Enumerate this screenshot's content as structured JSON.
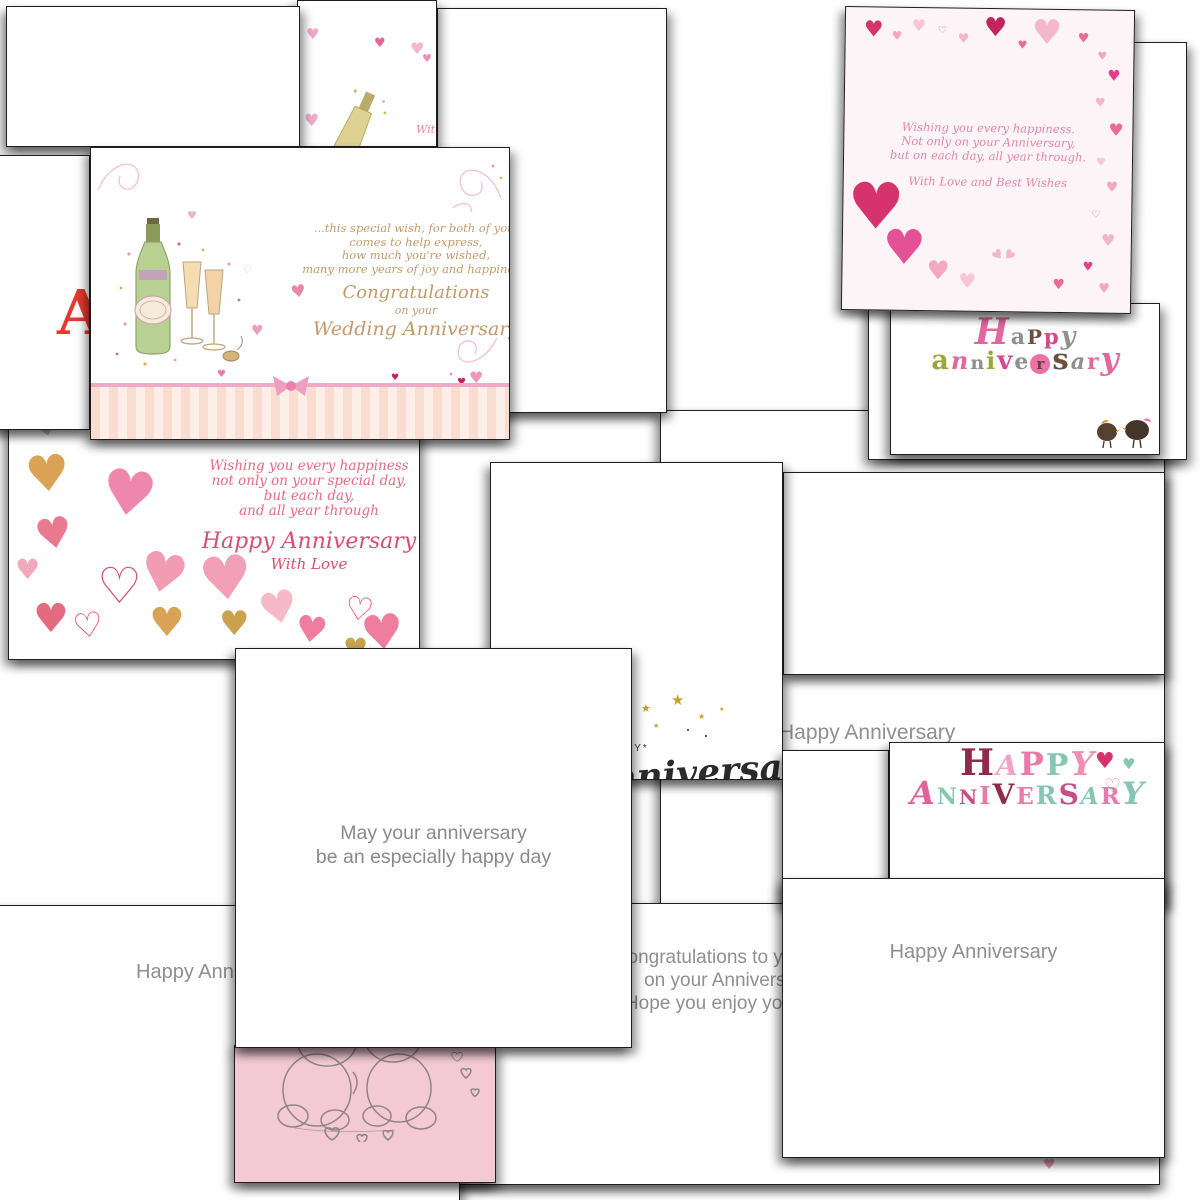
{
  "cards": {
    "front_fragment": {
      "partial_text": "Wit"
    },
    "wedding": {
      "verse": [
        "...this special wish, for both of you,",
        "comes to help express,",
        "how much you're wished,",
        "many more years of joy and happiness."
      ],
      "script1": "Congratulations",
      "script2": "on your",
      "script3": "Wedding Anniversary"
    },
    "letter_fragment": {
      "letter": "A"
    },
    "hearts_border": {
      "verse": [
        "Wishing you every happiness.",
        "Not only on your Anniversary,",
        "but on each day, all year through."
      ],
      "closing": "With Love and Best Wishes"
    },
    "birds": {
      "word1": [
        [
          "H",
          "#e2679f",
          36,
          "i"
        ],
        [
          "a",
          "#8f8f8f",
          22
        ],
        [
          "P",
          "#6b4f3f",
          20
        ],
        [
          "p",
          "#d5488f",
          21
        ],
        [
          "y",
          "#8f8f8f",
          25,
          "i"
        ]
      ],
      "word2": [
        [
          "a",
          "#9aa83b",
          27
        ],
        [
          "n",
          "#e2679f",
          24,
          "i"
        ],
        [
          "n",
          "#8f8f8f",
          19
        ],
        [
          "i",
          "#9aa83b",
          24
        ],
        [
          "v",
          "#d5488f",
          26
        ],
        [
          "e",
          "#8f8f8f",
          22
        ],
        [
          "r",
          "#5c4632",
          15,
          "dot"
        ],
        [
          "s",
          "#6b4f3f",
          29
        ],
        [
          "a",
          "#8f8f8f",
          22,
          "i"
        ],
        [
          "r",
          "#e2679f",
          22
        ],
        [
          "y",
          "#e2679f",
          31,
          "i"
        ]
      ]
    },
    "watercolor": {
      "verse": [
        "Wishing you every happiness",
        "not only on your special day,",
        "but each day,",
        "and all year through"
      ],
      "script": "Happy Anniversary",
      "closing": "With Love"
    },
    "gold_script": {
      "caps": "HAPPY*",
      "script": "anniversary!"
    },
    "middle": {
      "line1": "May your anniversary",
      "line2": "be an especially happy day"
    },
    "strip": {
      "text": "Happy Anniversary"
    },
    "congrats": {
      "line1": "Congratulations to you both",
      "line2": "on your Anniversary.",
      "line3": "Hope you enjoy your day"
    },
    "bottom_right": {
      "text": "Happy Anniversary"
    },
    "bottom_left": {
      "text": "Happy Anniversary"
    },
    "colorful": {
      "word1": [
        [
          "H",
          "#8e2a4a",
          36
        ],
        [
          "A",
          "#f0a3c4",
          28,
          "i"
        ],
        [
          "P",
          "#e87ba8",
          32
        ],
        [
          "P",
          "#86c7b4",
          30
        ],
        [
          "Y",
          "#ef8fb4",
          33,
          "i"
        ]
      ],
      "word2": [
        [
          "A",
          "#e0619c",
          32,
          "i"
        ],
        [
          "N",
          "#86c7b4",
          22
        ],
        [
          "N",
          "#c84f86",
          20
        ],
        [
          "I",
          "#e87ba8",
          24
        ],
        [
          "V",
          "#8e2a4a",
          28
        ],
        [
          "E",
          "#e87ba8",
          23
        ],
        [
          "R",
          "#86c7b4",
          25
        ],
        [
          "S",
          "#c84f86",
          28
        ],
        [
          "A",
          "#86c7b4",
          23,
          "i"
        ],
        [
          "R",
          "#e87ba8",
          23
        ],
        [
          "Y",
          "#86c7b4",
          31,
          "i"
        ]
      ]
    }
  },
  "colors": {
    "gold_text": "#c49a6c",
    "pink_text": "#e287ab",
    "rose_text": "#e46b80",
    "gray_text": "#8f8f8f",
    "card_border": "#1f1f1f",
    "teddy_bg": "#f3c9d3",
    "hearts_card_bg": "#fdf4f7"
  }
}
